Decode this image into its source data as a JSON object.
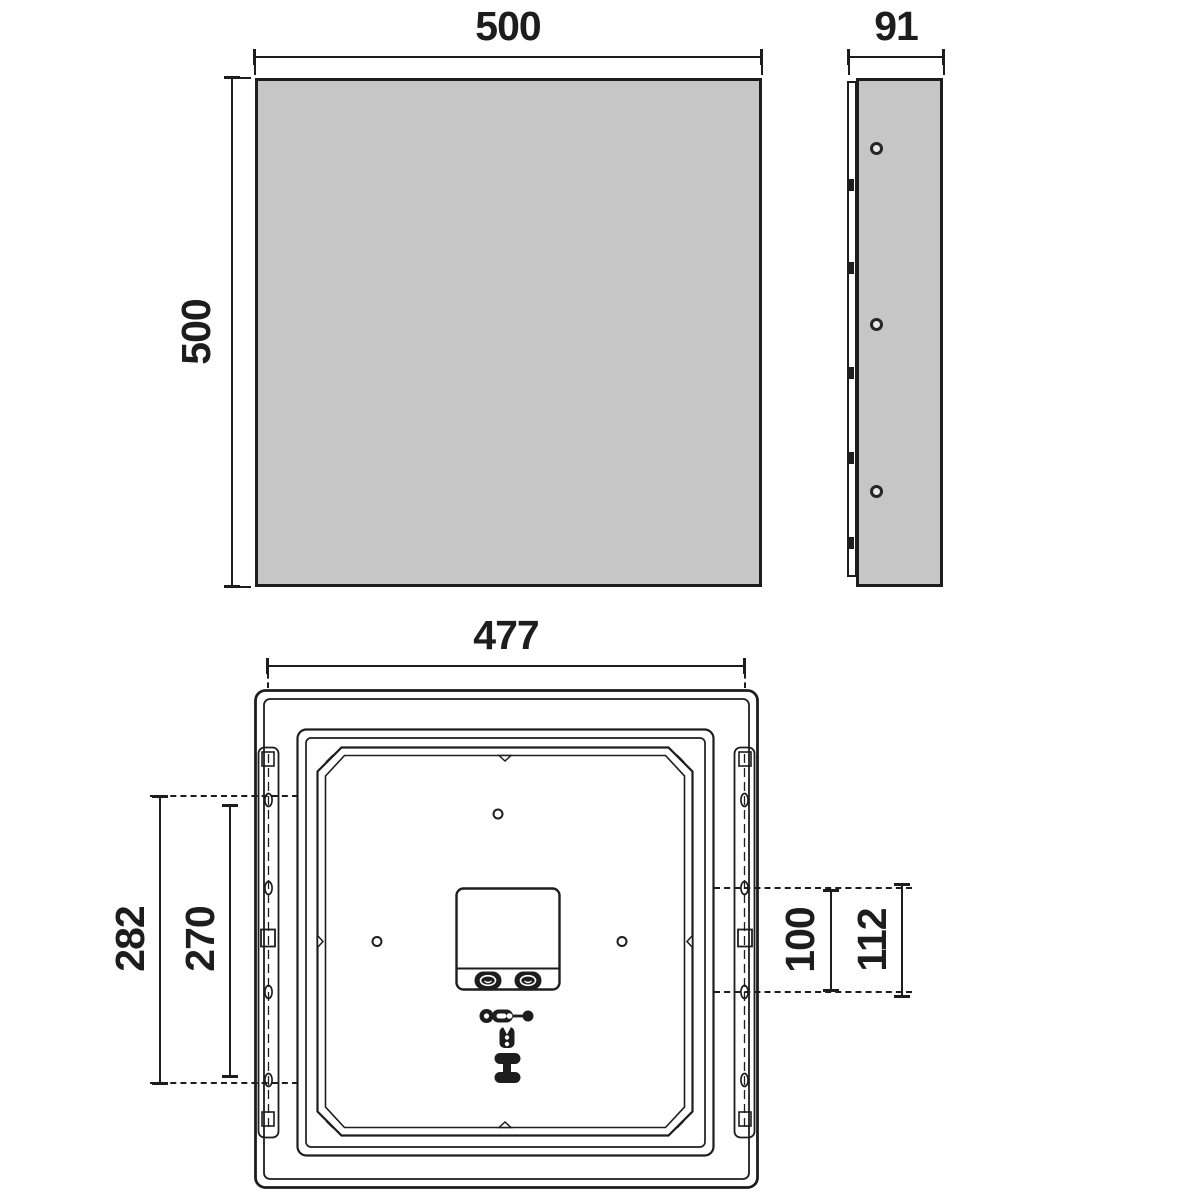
{
  "drawing": {
    "front_view": {
      "width_label": "500",
      "height_label": "500"
    },
    "side_view": {
      "width_label": "91"
    },
    "rear_view": {
      "width_label": "477",
      "left_outer_label": "282",
      "left_inner_label": "270",
      "right_inner_label": "100",
      "right_outer_label": "112"
    },
    "colors": {
      "panel_fill": "#c6c6c6",
      "line": "#1d1d1d",
      "background": "#ffffff"
    }
  }
}
